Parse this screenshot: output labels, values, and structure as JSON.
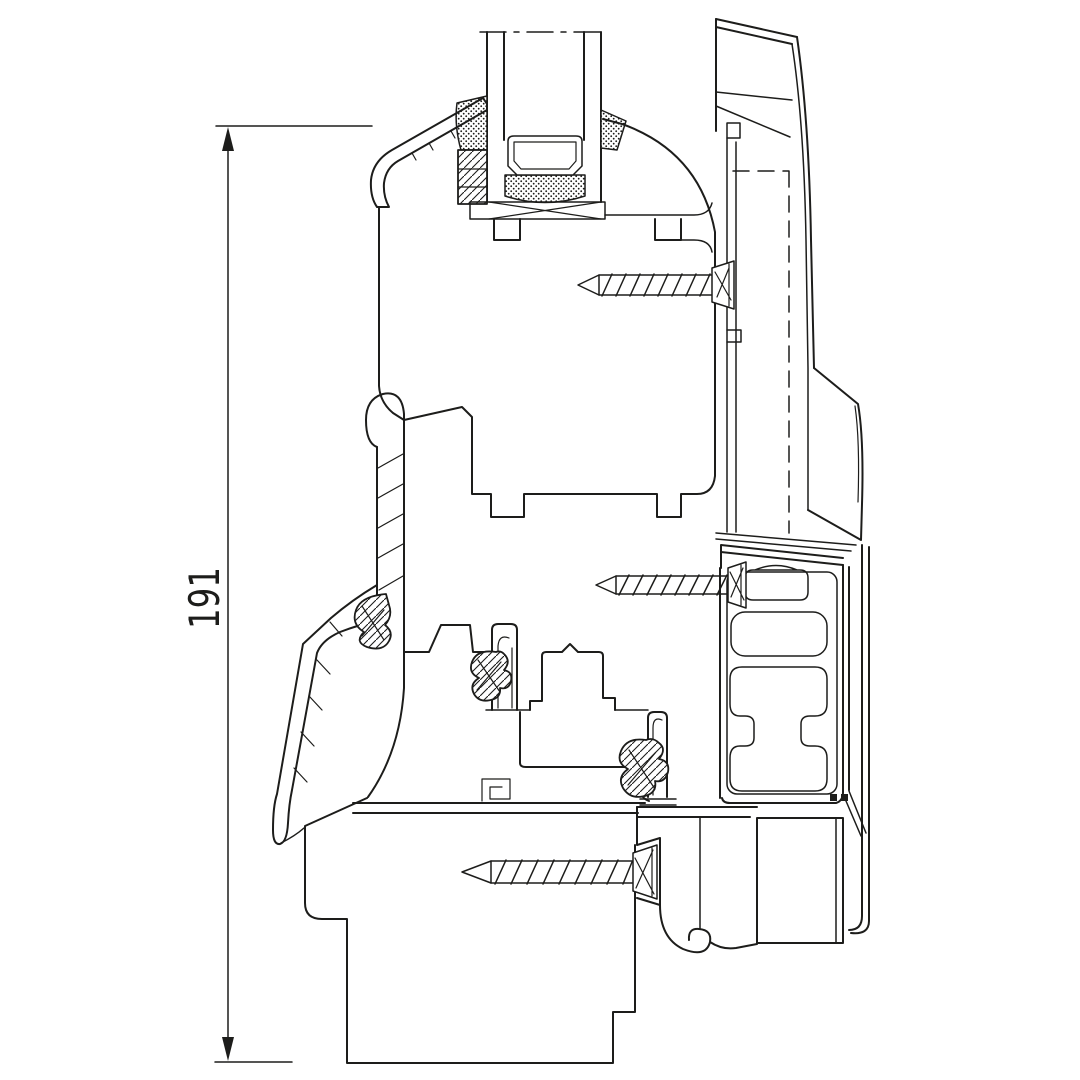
{
  "page": {
    "background_color": "#ffffff"
  },
  "drawing": {
    "kind": "window-profile-cross-section",
    "line_color": "#1d1d1b",
    "dimension": {
      "label": "191",
      "orientation": "vertical"
    },
    "components": [
      "insulated-glass-unit",
      "glazing-bead",
      "sash-profile",
      "sash-aluminium-cladding",
      "frame-profile",
      "frame-aluminium-cladding",
      "gaskets",
      "fixing-screws",
      "sill-clip"
    ]
  }
}
